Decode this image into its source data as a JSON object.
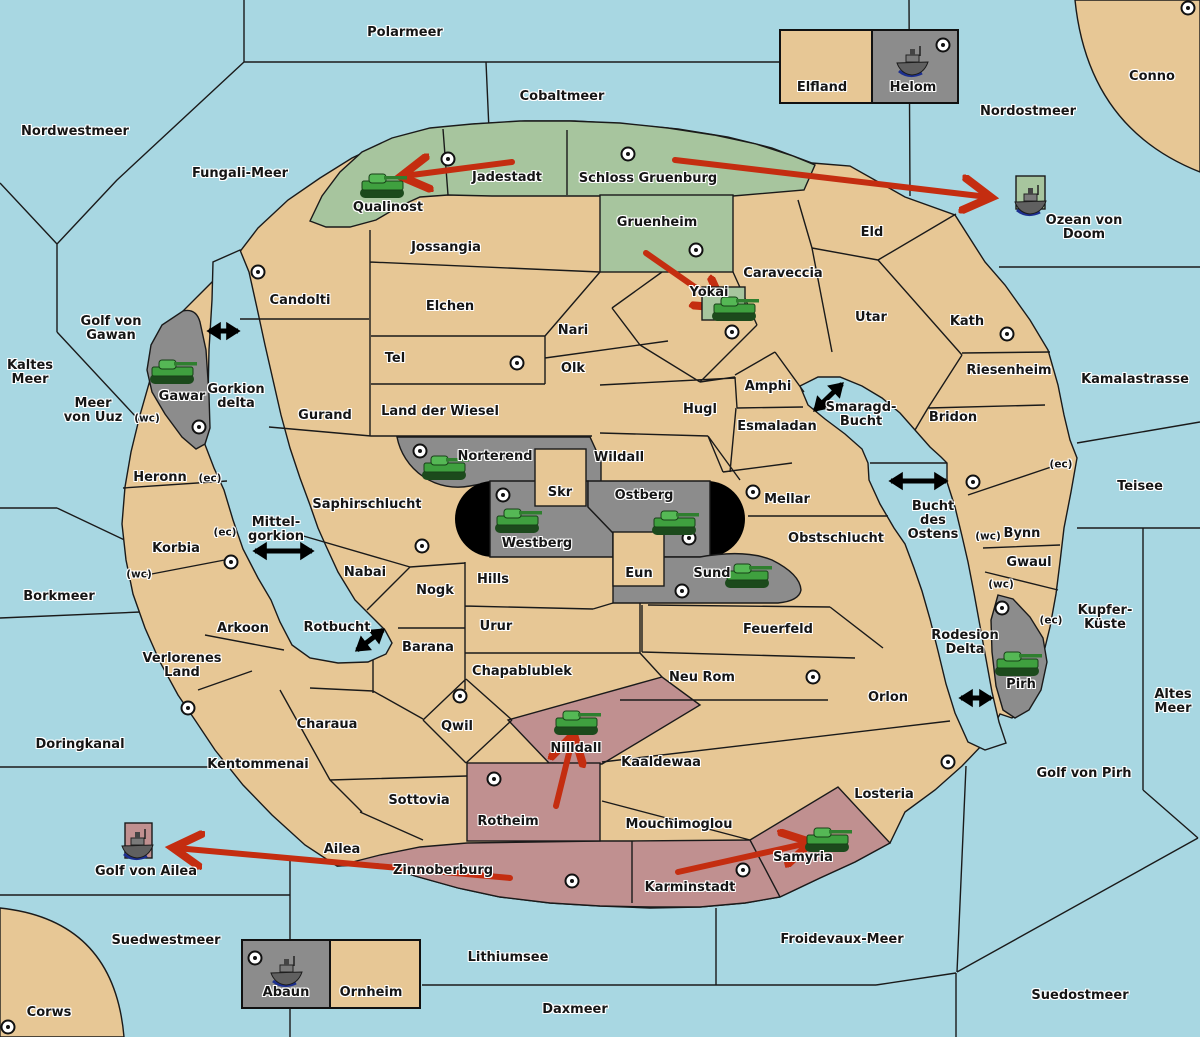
{
  "map_title": "Diplomacy-style conquest map",
  "colors": {
    "sea": "#A8D7E2",
    "land": "#E7C795",
    "green": "#A7C59E",
    "gray": "#8C8C8C",
    "pink": "#C09090",
    "red": "#C42D10"
  },
  "labels": [
    {
      "text": "Polarmeer",
      "x": 405,
      "y": 33
    },
    {
      "text": "Cobaltmeer",
      "x": 562,
      "y": 97
    },
    {
      "text": "Nordwestmeer",
      "x": 75,
      "y": 132
    },
    {
      "text": "Fungali-Meer",
      "x": 240,
      "y": 174
    },
    {
      "text": "Nordostmeer",
      "x": 1028,
      "y": 112
    },
    {
      "text": "Conno",
      "x": 1152,
      "y": 77
    },
    {
      "text": "Ozean von Doom",
      "x": 1084,
      "y": 228
    },
    {
      "text": "Golf von\nGawan",
      "x": 111,
      "y": 329
    },
    {
      "text": "Kaltes\nMeer",
      "x": 30,
      "y": 373
    },
    {
      "text": "Meer\nvon Uuz",
      "x": 93,
      "y": 411
    },
    {
      "text": "Gorkion\ndelta",
      "x": 236,
      "y": 397
    },
    {
      "text": "Mittel-\ngorkion",
      "x": 276,
      "y": 530
    },
    {
      "text": "Borkmeer",
      "x": 59,
      "y": 597
    },
    {
      "text": "Kamalastrasse",
      "x": 1135,
      "y": 380
    },
    {
      "text": "Teisee",
      "x": 1140,
      "y": 487
    },
    {
      "text": "Bucht\ndes\nOstens",
      "x": 933,
      "y": 521
    },
    {
      "text": "Kupfer-\nKüste",
      "x": 1105,
      "y": 618
    },
    {
      "text": "Altes\nMeer",
      "x": 1173,
      "y": 702
    },
    {
      "text": "Rodesion\nDelta",
      "x": 965,
      "y": 643
    },
    {
      "text": "Golf von Pirh",
      "x": 1084,
      "y": 774
    },
    {
      "text": "Doringkanal",
      "x": 80,
      "y": 745
    },
    {
      "text": "Golf von Ailea",
      "x": 146,
      "y": 872
    },
    {
      "text": "Suedwestmeer",
      "x": 166,
      "y": 941
    },
    {
      "text": "Corws",
      "x": 49,
      "y": 1013
    },
    {
      "text": "Lithiumsee",
      "x": 508,
      "y": 958
    },
    {
      "text": "Daxmeer",
      "x": 575,
      "y": 1010
    },
    {
      "text": "Froidevaux-Meer",
      "x": 842,
      "y": 940
    },
    {
      "text": "Suedostmeer",
      "x": 1080,
      "y": 996
    },
    {
      "text": "Rotbucht",
      "x": 337,
      "y": 628
    },
    {
      "text": "Smaragd-\nBucht",
      "x": 861,
      "y": 415
    },
    {
      "text": "Elfland",
      "x": 822,
      "y": 88
    },
    {
      "text": "Helom",
      "x": 913,
      "y": 88
    },
    {
      "text": "Abaun",
      "x": 286,
      "y": 993
    },
    {
      "text": "Ornheim",
      "x": 371,
      "y": 993
    },
    {
      "text": "Qualinost",
      "x": 388,
      "y": 208
    },
    {
      "text": "Jadestadt",
      "x": 507,
      "y": 178
    },
    {
      "text": "Schloss Gruenburg",
      "x": 648,
      "y": 179
    },
    {
      "text": "Gruenheim",
      "x": 657,
      "y": 223
    },
    {
      "text": "Yokai",
      "x": 709,
      "y": 293
    },
    {
      "text": "Caraveccia",
      "x": 783,
      "y": 274
    },
    {
      "text": "Eld",
      "x": 872,
      "y": 233
    },
    {
      "text": "Utar",
      "x": 871,
      "y": 318
    },
    {
      "text": "Kath",
      "x": 967,
      "y": 322
    },
    {
      "text": "Riesenheim",
      "x": 1009,
      "y": 371
    },
    {
      "text": "Bridon",
      "x": 953,
      "y": 418
    },
    {
      "text": "Bynn",
      "x": 1022,
      "y": 534
    },
    {
      "text": "Gwaul",
      "x": 1029,
      "y": 563
    },
    {
      "text": "Pirh",
      "x": 1021,
      "y": 685
    },
    {
      "text": "Candolti",
      "x": 300,
      "y": 301
    },
    {
      "text": "Jossangia",
      "x": 446,
      "y": 248
    },
    {
      "text": "Elchen",
      "x": 450,
      "y": 307
    },
    {
      "text": "Nari",
      "x": 573,
      "y": 331
    },
    {
      "text": "Tel",
      "x": 395,
      "y": 359
    },
    {
      "text": "Olk",
      "x": 573,
      "y": 369
    },
    {
      "text": "Gurand",
      "x": 325,
      "y": 416
    },
    {
      "text": "Land der Wiesel",
      "x": 440,
      "y": 412
    },
    {
      "text": "Hugl",
      "x": 700,
      "y": 410
    },
    {
      "text": "Amphi",
      "x": 768,
      "y": 387
    },
    {
      "text": "Esmaladan",
      "x": 777,
      "y": 427
    },
    {
      "text": "Mellar",
      "x": 787,
      "y": 500
    },
    {
      "text": "Obstschlucht",
      "x": 836,
      "y": 539
    },
    {
      "text": "Wildall",
      "x": 619,
      "y": 458
    },
    {
      "text": "Skr",
      "x": 560,
      "y": 493
    },
    {
      "text": "Ostberg",
      "x": 644,
      "y": 496
    },
    {
      "text": "Westberg",
      "x": 537,
      "y": 544
    },
    {
      "text": "Eun",
      "x": 639,
      "y": 574
    },
    {
      "text": "Sund",
      "x": 712,
      "y": 574
    },
    {
      "text": "Norterend",
      "x": 495,
      "y": 457
    },
    {
      "text": "Hills",
      "x": 493,
      "y": 580
    },
    {
      "text": "Nogk",
      "x": 435,
      "y": 591
    },
    {
      "text": "Nabai",
      "x": 365,
      "y": 573
    },
    {
      "text": "Saphirschlucht",
      "x": 367,
      "y": 505
    },
    {
      "text": "Heronn",
      "x": 160,
      "y": 478
    },
    {
      "text": "Korbia",
      "x": 176,
      "y": 549
    },
    {
      "text": "Arkoon",
      "x": 243,
      "y": 629
    },
    {
      "text": "Verlorenes\nLand",
      "x": 182,
      "y": 666
    },
    {
      "text": "Kentommenai",
      "x": 258,
      "y": 765
    },
    {
      "text": "Charaua",
      "x": 327,
      "y": 725
    },
    {
      "text": "Sottovia",
      "x": 419,
      "y": 801
    },
    {
      "text": "Ailea",
      "x": 342,
      "y": 850
    },
    {
      "text": "Zinnoberburg",
      "x": 443,
      "y": 871
    },
    {
      "text": "Karminstadt",
      "x": 690,
      "y": 888
    },
    {
      "text": "Samyria",
      "x": 803,
      "y": 858
    },
    {
      "text": "Mouchimoglou",
      "x": 679,
      "y": 825
    },
    {
      "text": "Kaaldewaa",
      "x": 661,
      "y": 763
    },
    {
      "text": "Neu Rom",
      "x": 702,
      "y": 678
    },
    {
      "text": "Feuerfeld",
      "x": 778,
      "y": 630
    },
    {
      "text": "Orlon",
      "x": 888,
      "y": 698
    },
    {
      "text": "Losteria",
      "x": 884,
      "y": 795
    },
    {
      "text": "Urur",
      "x": 496,
      "y": 627
    },
    {
      "text": "Barana",
      "x": 428,
      "y": 648
    },
    {
      "text": "Chapablublek",
      "x": 522,
      "y": 672
    },
    {
      "text": "Qwil",
      "x": 457,
      "y": 727
    },
    {
      "text": "Nilldall",
      "x": 576,
      "y": 749
    },
    {
      "text": "Rotheim",
      "x": 508,
      "y": 822
    },
    {
      "text": "Gawar",
      "x": 182,
      "y": 397
    },
    {
      "text": "(wc)",
      "x": 147,
      "y": 419,
      "small": true
    },
    {
      "text": "(ec)",
      "x": 210,
      "y": 479,
      "small": true
    },
    {
      "text": "(ec)",
      "x": 225,
      "y": 533,
      "small": true
    },
    {
      "text": "(wc)",
      "x": 139,
      "y": 575,
      "small": true
    },
    {
      "text": "(ec)",
      "x": 1061,
      "y": 465,
      "small": true
    },
    {
      "text": "(wc)",
      "x": 988,
      "y": 537,
      "small": true
    },
    {
      "text": "(wc)",
      "x": 1001,
      "y": 585,
      "small": true
    },
    {
      "text": "(ec)",
      "x": 1051,
      "y": 621,
      "small": true
    }
  ],
  "supply_centers": [
    {
      "x": 448,
      "y": 159
    },
    {
      "x": 628,
      "y": 154
    },
    {
      "x": 696,
      "y": 250
    },
    {
      "x": 732,
      "y": 332
    },
    {
      "x": 1188,
      "y": 8
    },
    {
      "x": 943,
      "y": 45
    },
    {
      "x": 258,
      "y": 272
    },
    {
      "x": 517,
      "y": 363
    },
    {
      "x": 199,
      "y": 427
    },
    {
      "x": 231,
      "y": 562
    },
    {
      "x": 422,
      "y": 546
    },
    {
      "x": 420,
      "y": 451
    },
    {
      "x": 503,
      "y": 495
    },
    {
      "x": 689,
      "y": 538
    },
    {
      "x": 753,
      "y": 492
    },
    {
      "x": 682,
      "y": 591
    },
    {
      "x": 460,
      "y": 696
    },
    {
      "x": 494,
      "y": 779
    },
    {
      "x": 813,
      "y": 677
    },
    {
      "x": 948,
      "y": 762
    },
    {
      "x": 1007,
      "y": 334
    },
    {
      "x": 973,
      "y": 482
    },
    {
      "x": 1002,
      "y": 608
    },
    {
      "x": 188,
      "y": 708
    },
    {
      "x": 743,
      "y": 870
    },
    {
      "x": 572,
      "y": 881
    },
    {
      "x": 255,
      "y": 958
    },
    {
      "x": 8,
      "y": 1027
    }
  ],
  "units": [
    {
      "type": "army",
      "region": "Qualinost",
      "x": 383,
      "y": 186
    },
    {
      "type": "army",
      "region": "Gawar",
      "x": 173,
      "y": 372
    },
    {
      "type": "army",
      "region": "Norterend",
      "x": 445,
      "y": 468
    },
    {
      "type": "army",
      "region": "Westberg",
      "x": 518,
      "y": 521
    },
    {
      "type": "army",
      "region": "Ostberg",
      "x": 675,
      "y": 523
    },
    {
      "type": "army",
      "region": "Sund",
      "x": 748,
      "y": 576
    },
    {
      "type": "army",
      "region": "Yokai",
      "x": 735,
      "y": 309,
      "bg": {
        "x": 702,
        "y": 287,
        "w": 43,
        "h": 33,
        "color": "green"
      }
    },
    {
      "type": "army",
      "region": "Nilldall",
      "x": 577,
      "y": 723
    },
    {
      "type": "army",
      "region": "Samyria",
      "x": 828,
      "y": 840
    },
    {
      "type": "army",
      "region": "Pirh",
      "x": 1018,
      "y": 664
    },
    {
      "type": "fleet",
      "region": "Helom",
      "x": 913,
      "y": 61
    },
    {
      "type": "fleet",
      "region": "Ozean von Doom",
      "x": 1031,
      "y": 200,
      "bg": {
        "x": 1016,
        "y": 176,
        "w": 29,
        "h": 33,
        "color": "green"
      }
    },
    {
      "type": "fleet",
      "region": "Golf von Ailea",
      "x": 138,
      "y": 844,
      "bg": {
        "x": 125,
        "y": 823,
        "w": 27,
        "h": 35,
        "color": "pink"
      }
    },
    {
      "type": "fleet",
      "region": "Abaun",
      "x": 287,
      "y": 971
    }
  ],
  "orders": [
    {
      "from": "Jadestadt",
      "to": "Qualinost",
      "x1": 512,
      "y1": 162,
      "x2": 404,
      "y2": 176
    },
    {
      "from": "Schloss Gruenburg",
      "to": "Ozean von Doom",
      "x1": 675,
      "y1": 160,
      "x2": 988,
      "y2": 197
    },
    {
      "from": "Gruenheim",
      "to": "Yokai",
      "x1": 646,
      "y1": 253,
      "x2": 722,
      "y2": 306
    },
    {
      "from": "Rotheim",
      "to": "Nilldall",
      "x1": 556,
      "y1": 806,
      "x2": 573,
      "y2": 737
    },
    {
      "from": "Karminstadt",
      "to": "Samyria",
      "x1": 678,
      "y1": 872,
      "x2": 808,
      "y2": 843
    },
    {
      "from": "Zinnoberburg",
      "to": "Golf von Ailea",
      "x1": 510,
      "y1": 878,
      "x2": 176,
      "y2": 848
    }
  ],
  "links": [
    {
      "x1": 209,
      "y1": 331,
      "x2": 238,
      "y2": 331
    },
    {
      "x1": 255,
      "y1": 551,
      "x2": 312,
      "y2": 551
    },
    {
      "x1": 357,
      "y1": 650,
      "x2": 383,
      "y2": 630
    },
    {
      "x1": 815,
      "y1": 410,
      "x2": 842,
      "y2": 384
    },
    {
      "x1": 891,
      "y1": 481,
      "x2": 946,
      "y2": 481
    },
    {
      "x1": 961,
      "y1": 698,
      "x2": 991,
      "y2": 698
    }
  ]
}
